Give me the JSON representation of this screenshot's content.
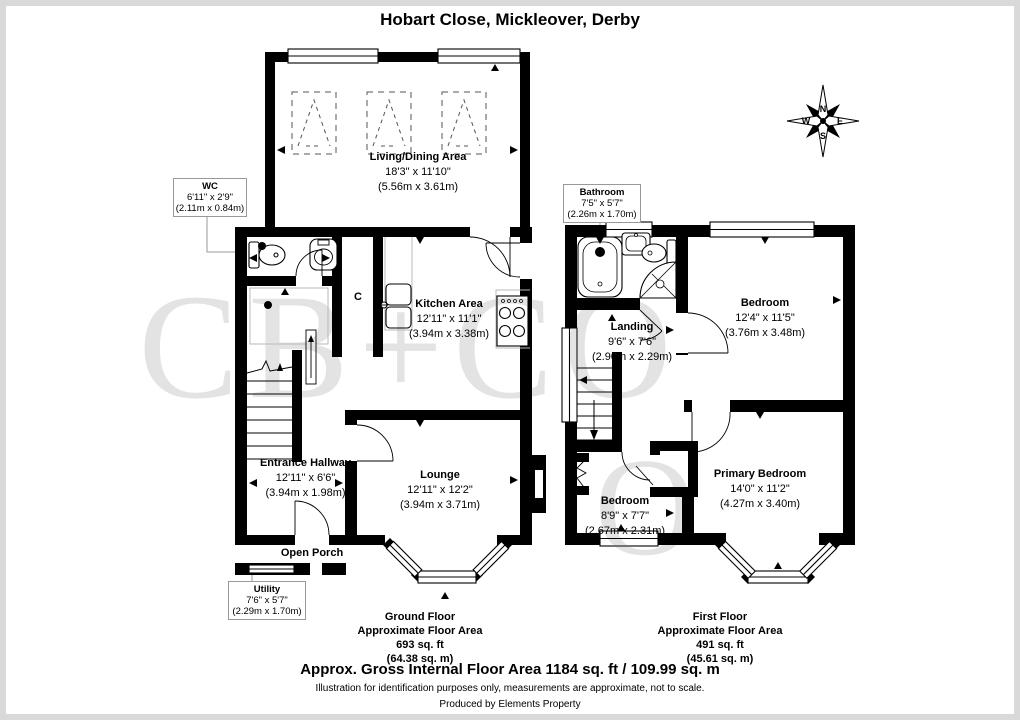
{
  "title": "Hobart Close, Mickleover, Derby",
  "compass": {
    "n": "N",
    "e": "E",
    "s": "S",
    "w": "W"
  },
  "watermark": {
    "text": "CB+CO",
    "text2": "O"
  },
  "ground": {
    "rooms": {
      "living": {
        "name": "Living/Dining Area",
        "ft": "18'3\" x 11'10\"",
        "m": "(5.56m x 3.61m)"
      },
      "wc": {
        "name": "WC",
        "ft": "6'11\" x 2'9\"",
        "m": "(2.11m x 0.84m)"
      },
      "kitchen": {
        "name": "Kitchen Area",
        "ft": "12'11\" x 11'1\"",
        "m": "(3.94m x 3.38m)"
      },
      "hallway": {
        "name": "Entrance Hallway",
        "ft": "12'11\" x 6'6\"",
        "m": "(3.94m x 1.98m)"
      },
      "lounge": {
        "name": "Lounge",
        "ft": "12'11\" x 12'2\"",
        "m": "(3.94m x 3.71m)"
      },
      "porch": {
        "name": "Open Porch"
      },
      "utility": {
        "name": "Utility",
        "ft": "7'6\" x 5'7\"",
        "m": "(2.29m x 1.70m)"
      },
      "cupboard": {
        "name": "C"
      }
    },
    "footer": {
      "floor": "Ground Floor",
      "label": "Approximate Floor Area",
      "sqft": "693 sq. ft",
      "sqm": "(64.38 sq. m)"
    }
  },
  "first": {
    "rooms": {
      "bathroom": {
        "name": "Bathroom",
        "ft": "7'5\" x 5'7\"",
        "m": "(2.26m x 1.70m)"
      },
      "landing": {
        "name": "Landing",
        "ft": "9'6\" x 7'6\"",
        "m": "(2.90m x 2.29m)"
      },
      "bedroom1": {
        "name": "Bedroom",
        "ft": "12'4\" x 11'5\"",
        "m": "(3.76m x 3.48m)"
      },
      "bedroom2": {
        "name": "Bedroom",
        "ft": "8'9\" x 7'7\"",
        "m": "(2.67m x 2.31m)"
      },
      "primary": {
        "name": "Primary Bedroom",
        "ft": "14'0\" x 11'2\"",
        "m": "(4.27m x 3.40m)"
      }
    },
    "footer": {
      "floor": "First Floor",
      "label": "Approximate Floor Area",
      "sqft": "491 sq. ft",
      "sqm": "(45.61 sq. m)"
    }
  },
  "summary": {
    "gross": "Approx. Gross Internal Floor Area 1184 sq. ft / 109.99 sq. m",
    "disclaimer": "Illustration for identification purposes only, measurements are approximate, not to scale.",
    "producer": "Produced by Elements Property"
  },
  "colors": {
    "wall": "#000000",
    "callout_border": "#999999",
    "watermark": "#e3e3e3",
    "frame": "#d9d9d9"
  }
}
